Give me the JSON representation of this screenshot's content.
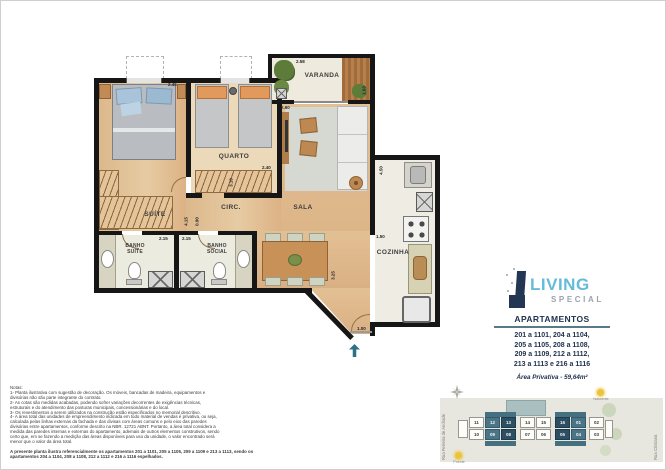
{
  "floorplan": {
    "rooms": {
      "suite": "SUÍTE",
      "quarto": "QUARTO",
      "circ": "CIRC.",
      "sala": "SALA",
      "varanda": "VARANDA",
      "cozinha": "COZINHA",
      "banho_suite_1": "BANHO",
      "banho_suite_2": "SUÍTE",
      "banho_social_1": "BANHO",
      "banho_social_2": "SOCIAL"
    },
    "dims": {
      "suite_top": "2.45",
      "varanda_top": "2.58",
      "varanda_side": "1.63",
      "sala_top": "2.60",
      "quarto_bottom": "2.40",
      "quarto_side": "3.10",
      "circ_len": "4.15",
      "circ_wid": "0.90",
      "banho_suite": "2.15",
      "banho_social": "2.15",
      "cozinha_side": "4.50",
      "cozinha_pass": "1.50",
      "sala_side": "3.25",
      "entry": "1.00"
    },
    "entry_arrow_color": "#2e7085"
  },
  "brand": {
    "logo_living": "LIVING",
    "logo_special": "SPECIAL",
    "accent_blue": "#64bcd9",
    "navy": "#22334f",
    "apartments_title": "APARTAMENTOS",
    "apartments_lines": [
      "201 a 1101, 204 a 1104,",
      "205 a 1105, 208 a 1108,",
      "209 a 1109, 212 a 1112,",
      "213 a 1113 e 216 a 1116"
    ],
    "area_label": "Área Privativa - 59,64m²"
  },
  "notes": {
    "title": "Notas:",
    "items": [
      "1- Planta ilustrativa com sugestão de decoração. Os móveis, bancadas de madeira, equipamentos e divisórias não são parte integrante do contrato.",
      "2- As cotas são medidas acabadas, podendo sofrer variações decorrentes de exigências técnicas, estruturais e do atendimento das posturas municipais, concessionárias e do local.",
      "3- Os revestimentos a serem utilizados na construção estão especificados no memorial descritivo.",
      "4- A área total das unidades de empreendimento indicada em todo material de vendas é privativa, ou seja, calculada pelas linhas externas da fachada e das divisas com áreas comuns e pelo eixo das paredes divisórias entre apartamentos, conforme descrito na NBR. 12721 ABNT. Portanto, a área total considera a medida das paredes internas e externas do apartamento, ademais de outros elementos construtivos, sendo certo que, em se fazendo a medição das áreas disponíveis para uso da unidade, o valor encontrado será menor que o valor da área total."
    ],
    "footer": "A presente planta ilustra referencialmente os apartamentos 201 a 1101, 205 a 1105, 209 a 1109 e 213 a 1113, sendo os apartamentos 204 a 1104, 208 a 1108, 212 a 1112 e 216 a 1116 espelhados."
  },
  "sitemap": {
    "street_left": "Rua Ferreira de Andrade",
    "street_right": "Rua Cristiana",
    "sun_top_label": "Nascente",
    "sun_bottom_label": "Poente",
    "units_top": [
      "11",
      "12",
      "13",
      "14",
      "15",
      "16",
      "01",
      "02"
    ],
    "units_bottom": [
      "10",
      "09",
      "08",
      "07",
      "06",
      "05",
      "04",
      "03"
    ],
    "highlighted_units": [
      "12",
      "13",
      "16",
      "01",
      "09",
      "08",
      "05",
      "04"
    ],
    "highlight_color_outer": "#4a7589",
    "highlight_color_inner": "#2c4f63"
  }
}
